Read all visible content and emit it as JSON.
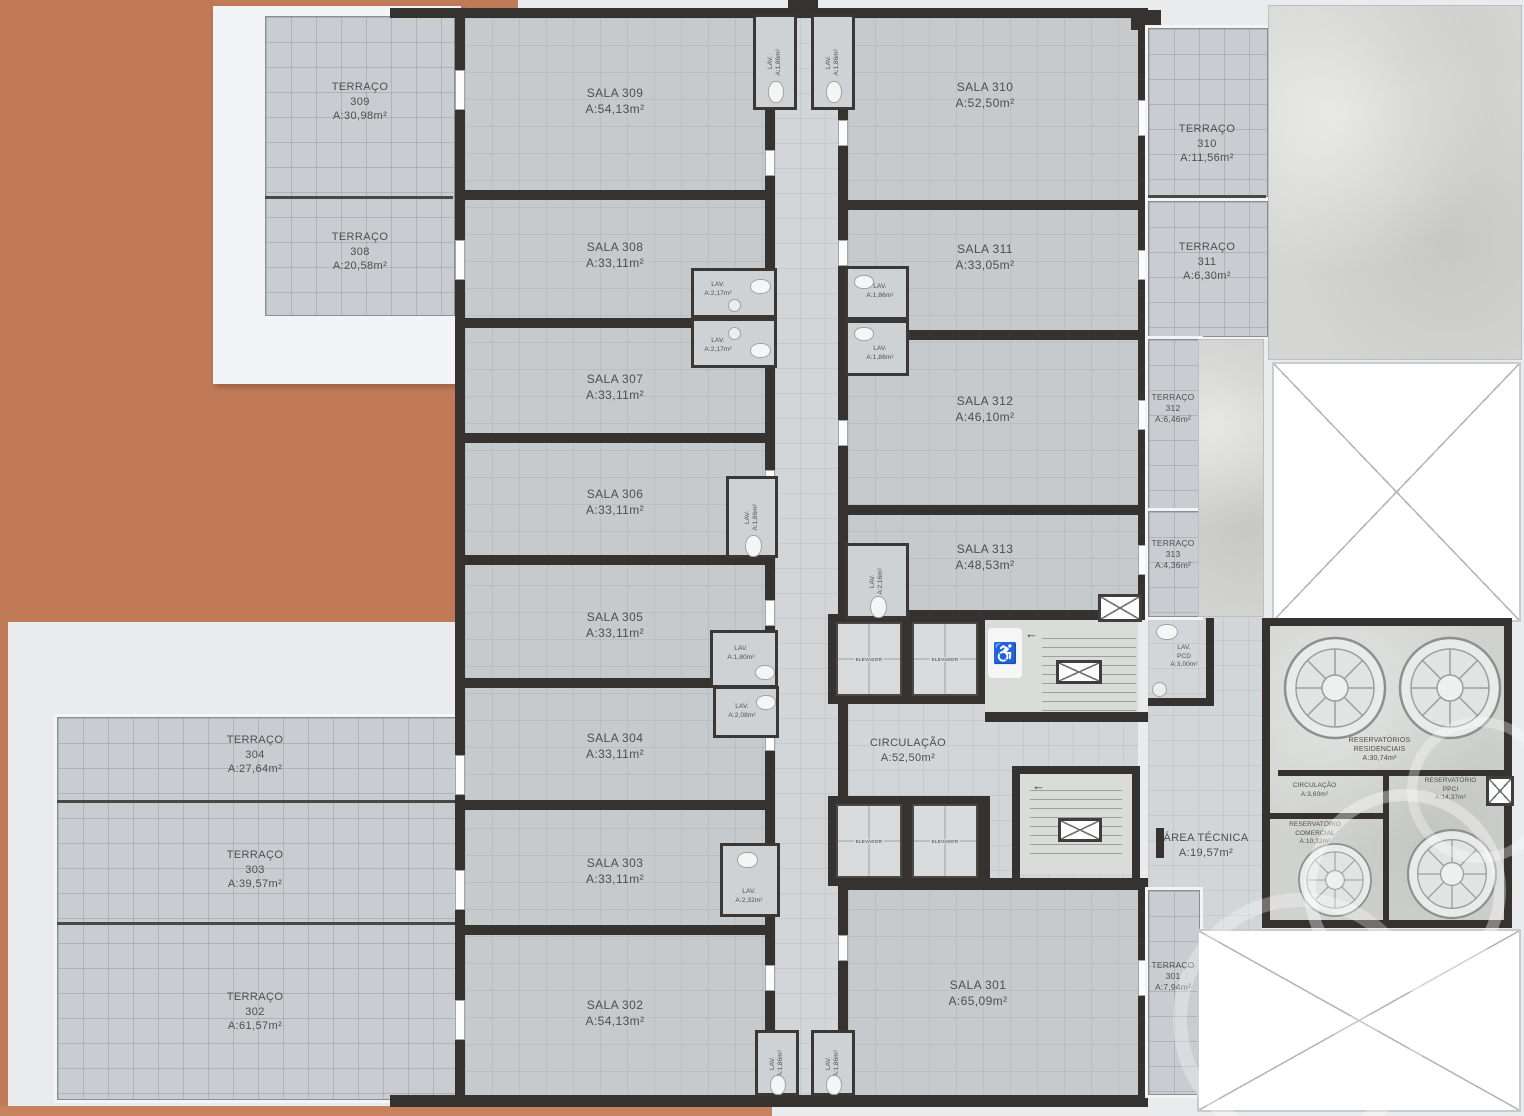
{
  "palette": {
    "orange": "#c17a57",
    "wall": "#35322f",
    "room_gray": "#c6cacd",
    "corridor_gray": "#d3d6d8",
    "tile_gray": "#c9cdd1",
    "concrete": "#d5d6d3",
    "background": "#e9ebed"
  },
  "salas": {
    "s301": {
      "name": "SALA 301",
      "area": "A:65,09m²"
    },
    "s302": {
      "name": "SALA 302",
      "area": "A:54,13m²"
    },
    "s303": {
      "name": "SALA 303",
      "area": "A:33,11m²"
    },
    "s304": {
      "name": "SALA 304",
      "area": "A:33,11m²"
    },
    "s305": {
      "name": "SALA 305",
      "area": "A:33,11m²"
    },
    "s306": {
      "name": "SALA 306",
      "area": "A:33,11m²"
    },
    "s307": {
      "name": "SALA 307",
      "area": "A:33,11m²"
    },
    "s308": {
      "name": "SALA 308",
      "area": "A:33,11m²"
    },
    "s309": {
      "name": "SALA 309",
      "area": "A:54,13m²"
    },
    "s310": {
      "name": "SALA 310",
      "area": "A:52,50m²"
    },
    "s311": {
      "name": "SALA 311",
      "area": "A:33,05m²"
    },
    "s312": {
      "name": "SALA 312",
      "area": "A:46,10m²"
    },
    "s313": {
      "name": "SALA 313",
      "area": "A:48,53m²"
    }
  },
  "terracos": {
    "t301": {
      "name": "TERRAÇO",
      "num": "301",
      "area": "A:7,94m²"
    },
    "t302": {
      "name": "TERRAÇO",
      "num": "302",
      "area": "A:61,57m²"
    },
    "t303": {
      "name": "TERRAÇO",
      "num": "303",
      "area": "A:39,57m²"
    },
    "t304": {
      "name": "TERRAÇO",
      "num": "304",
      "area": "A:27,64m²"
    },
    "t308": {
      "name": "TERRAÇO",
      "num": "308",
      "area": "A:20,58m²"
    },
    "t309": {
      "name": "TERRAÇO",
      "num": "309",
      "area": "A:30,98m²"
    },
    "t310": {
      "name": "TERRAÇO",
      "num": "310",
      "area": "A:11,56m²"
    },
    "t311": {
      "name": "TERRAÇO",
      "num": "311",
      "area": "A:6,30m²"
    },
    "t312": {
      "name": "TERRAÇO",
      "num": "312",
      "area": "A:6,46m²"
    },
    "t313": {
      "name": "TERRAÇO",
      "num": "313",
      "area": "A:4,36m²"
    }
  },
  "lavs": {
    "top_left": {
      "name": "LAV.",
      "area": "A:1,86m²"
    },
    "top_right": {
      "name": "LAV.",
      "area": "A:1,86m²"
    },
    "mid_left_upper": {
      "name": "LAV.",
      "area": "A:2,17m²"
    },
    "mid_left_lower": {
      "name": "LAV.",
      "area": "A:2,17m²"
    },
    "mid_right_upper": {
      "name": "LAV.",
      "area": "A:1,86m²"
    },
    "mid_right_lower": {
      "name": "LAV.",
      "area": "A:1,86m²"
    },
    "sala306": {
      "name": "LAV.",
      "area": "A:1,86m²"
    },
    "sala313": {
      "name": "LAV.",
      "area": "A:2,16m²"
    },
    "sala305": {
      "name": "LAV.",
      "area": "A:1,80m²"
    },
    "sala304": {
      "name": "LAV.",
      "area": "A:2,08m²"
    },
    "sala303": {
      "name": "LAV.",
      "area": "A:2,32m²"
    },
    "bottom_left": {
      "name": "LAV.",
      "area": "A:1,86m²"
    },
    "bottom_right": {
      "name": "LAV.",
      "area": "A:1,86m²"
    },
    "pcd": {
      "name": "LAV.",
      "sub": "PCD",
      "area": "A:3,00m²"
    }
  },
  "core": {
    "circulacao": {
      "name": "CIRCULAÇÃO",
      "area": "A:52,50m²"
    },
    "area_tecnica": {
      "name": "ÁREA TÉCNICA",
      "area": "A:19,57m²"
    },
    "elevador": "ELEVADOR"
  },
  "reservatorios": {
    "residenciais": {
      "l1": "RESERVATÓRIOS",
      "l2": "RESIDENCIAIS",
      "area": "A:30,74m²"
    },
    "circulacao": {
      "name": "CIRCULAÇÃO",
      "area": "A:3,60m²"
    },
    "ppci": {
      "l1": "RESERVATÓRIO",
      "l2": "PPCI",
      "area": "A:14,37m²"
    },
    "comercial": {
      "l1": "RESERVATÓRIO",
      "l2": "COMERCIAL",
      "area": "A:10,32m²"
    }
  }
}
